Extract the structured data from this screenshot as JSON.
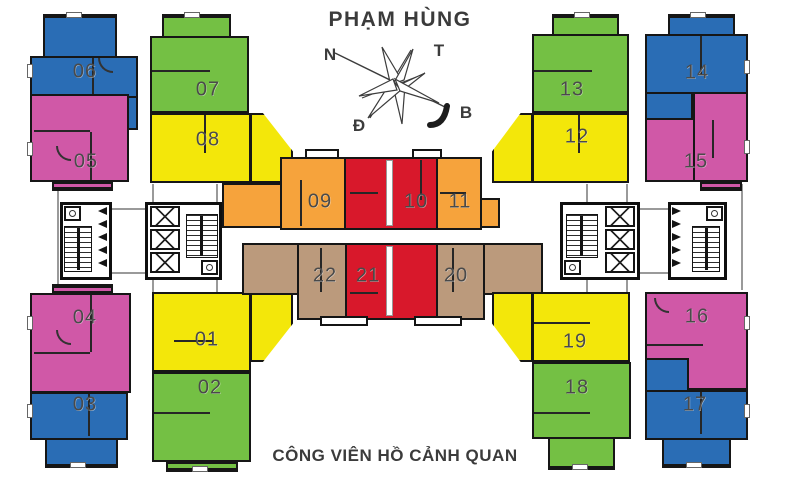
{
  "title": "PHẠM HÙNG",
  "park_label": "CÔNG VIÊN HỒ CẢNH QUAN",
  "compass": {
    "labels": {
      "nw": "N",
      "ne": "T",
      "sw": "Đ",
      "se": "B"
    }
  },
  "legend_colors": {
    "blue": "#2a6db5",
    "green": "#74c044",
    "pink": "#d058a7",
    "yellow": "#f3e70a",
    "orange": "#f6a33c",
    "red": "#d8182b",
    "tan": "#bb9a7c"
  },
  "units": [
    {
      "label": "01",
      "color": "yellow"
    },
    {
      "label": "02",
      "color": "green"
    },
    {
      "label": "03",
      "color": "blue"
    },
    {
      "label": "04",
      "color": "pink"
    },
    {
      "label": "05",
      "color": "pink"
    },
    {
      "label": "06",
      "color": "blue"
    },
    {
      "label": "07",
      "color": "green"
    },
    {
      "label": "08",
      "color": "yellow"
    },
    {
      "label": "09",
      "color": "orange"
    },
    {
      "label": "10",
      "color": "red"
    },
    {
      "label": "11",
      "color": "orange"
    },
    {
      "label": "12",
      "color": "yellow"
    },
    {
      "label": "13",
      "color": "green"
    },
    {
      "label": "14",
      "color": "blue"
    },
    {
      "label": "15",
      "color": "pink"
    },
    {
      "label": "16",
      "color": "pink"
    },
    {
      "label": "17",
      "color": "blue"
    },
    {
      "label": "18",
      "color": "green"
    },
    {
      "label": "19",
      "color": "yellow"
    },
    {
      "label": "20",
      "color": "tan"
    },
    {
      "label": "21",
      "color": "red"
    },
    {
      "label": "22",
      "color": "tan"
    }
  ]
}
